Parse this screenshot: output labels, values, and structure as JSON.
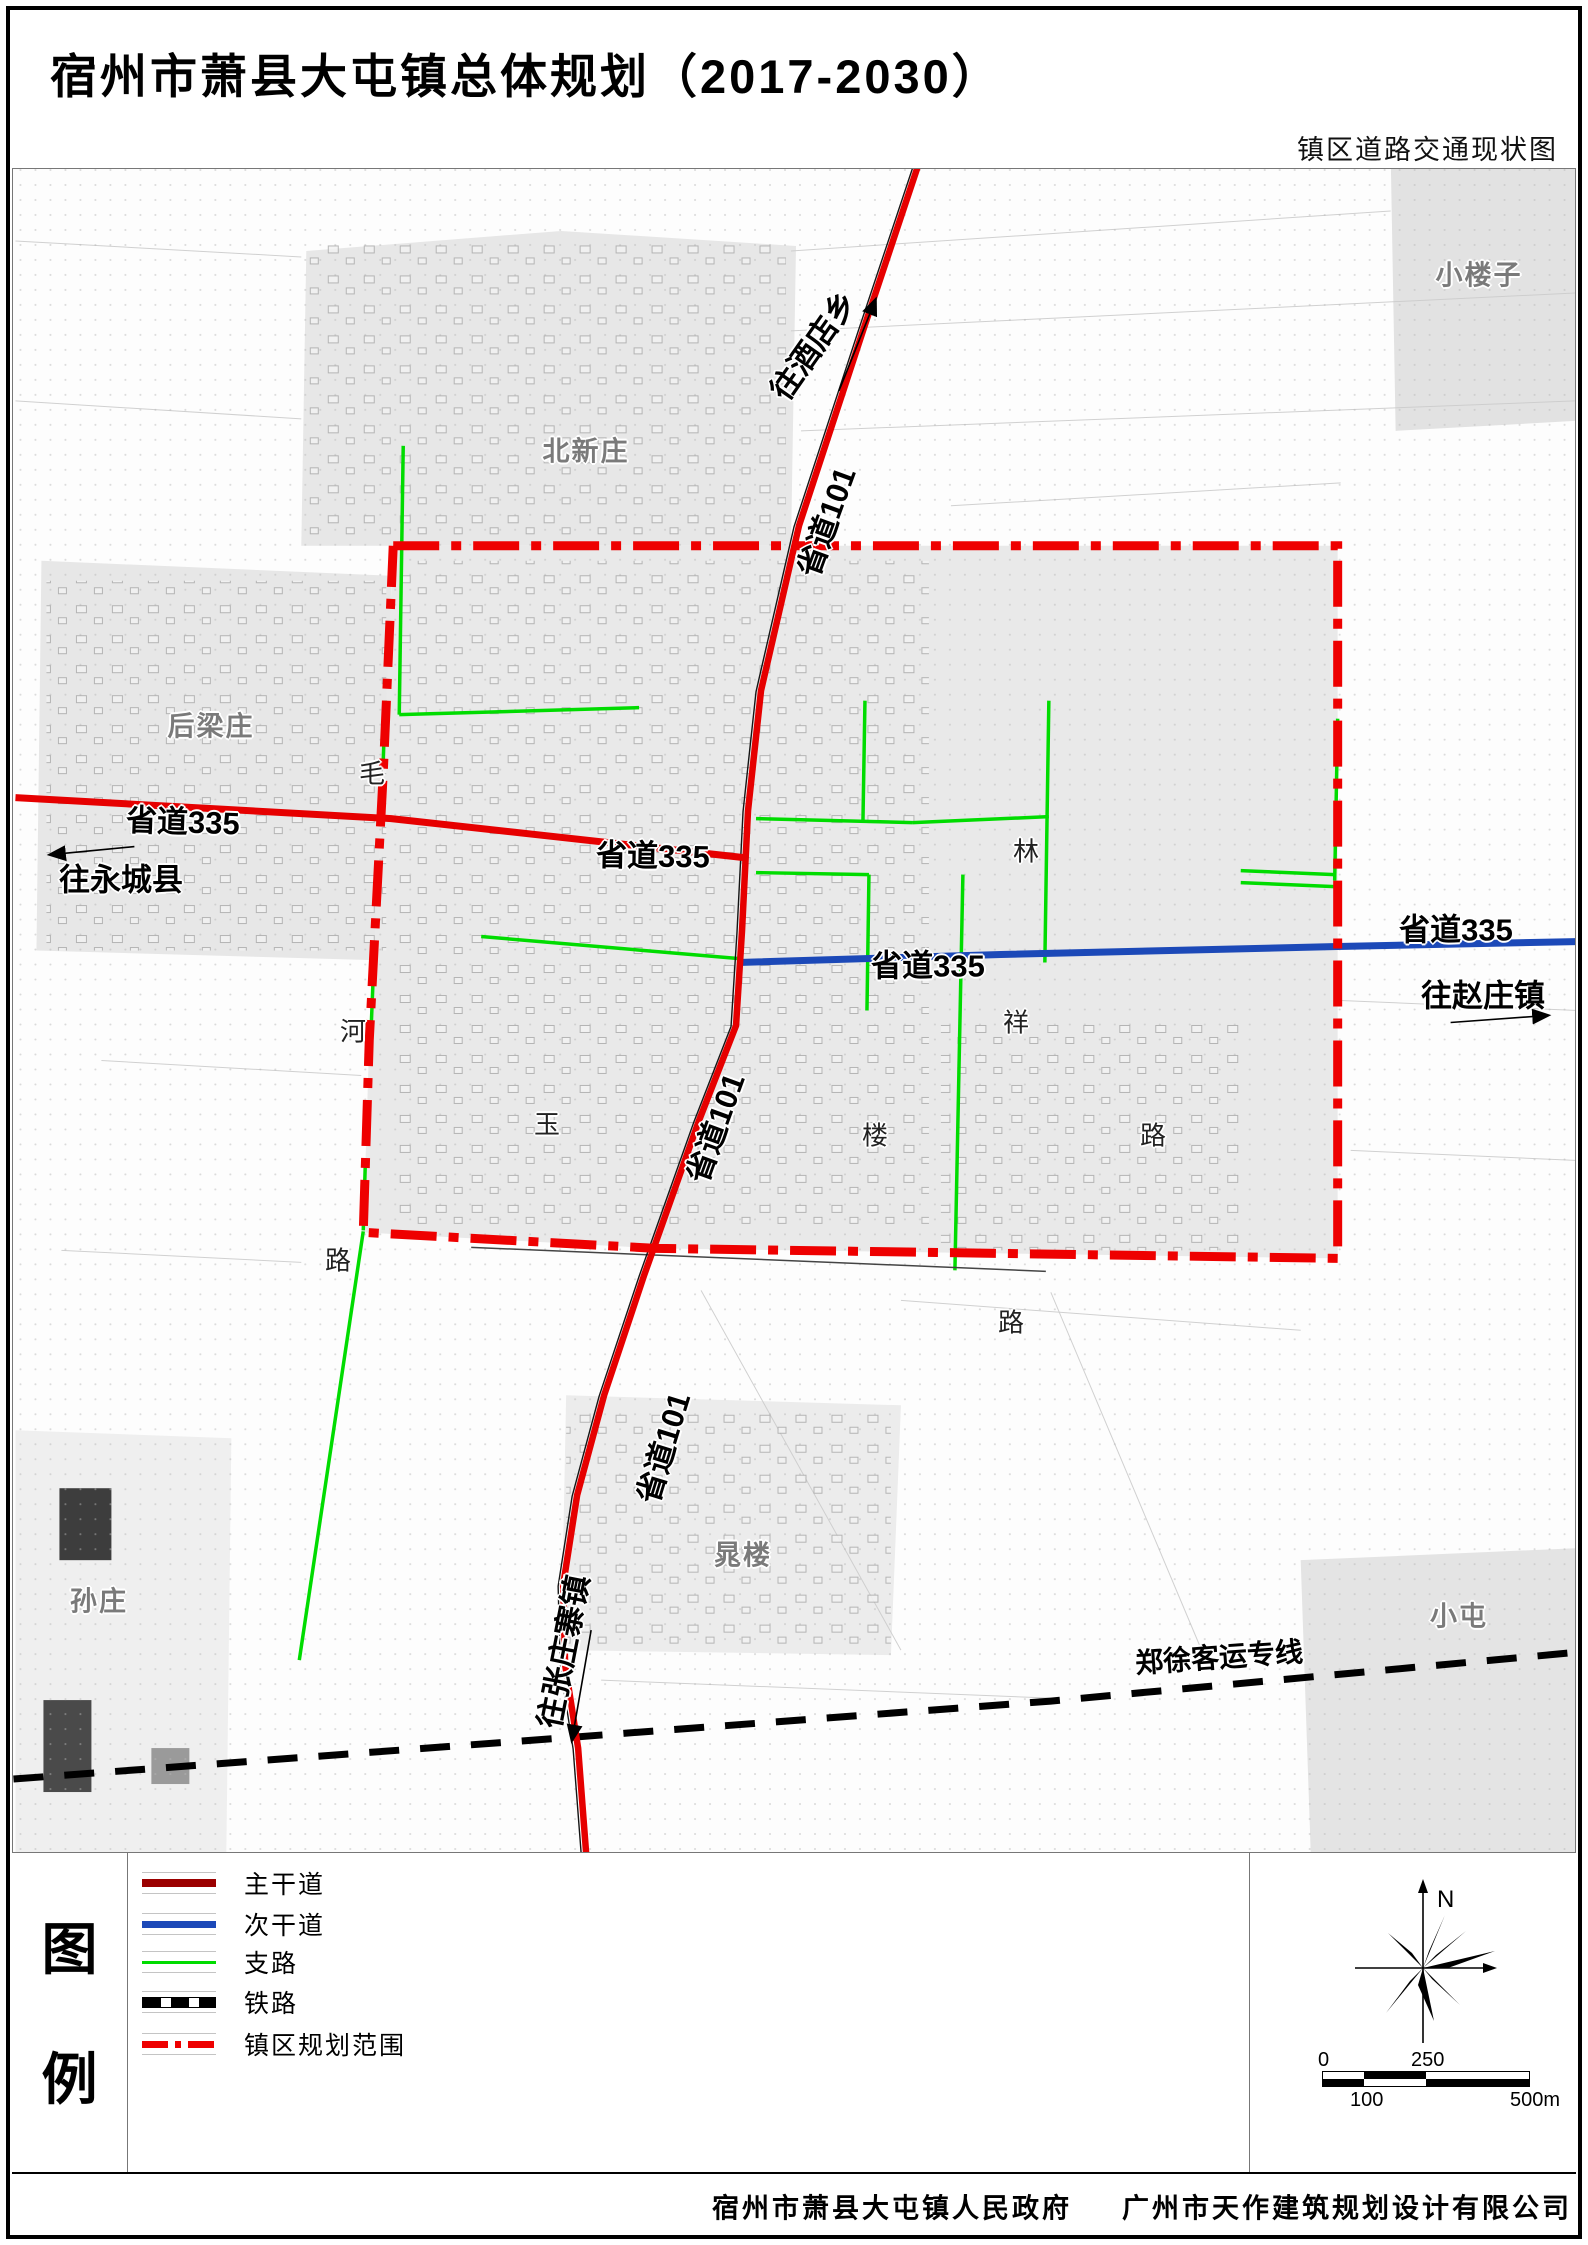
{
  "page": {
    "title": "宿州市萧县大屯镇总体规划（2017-2030）",
    "subtitle": "镇区道路交通现状图"
  },
  "colors": {
    "main_road": "#e60000",
    "main_road_legend": "#9b0000",
    "secondary_road": "#1c49b8",
    "branch_road": "#00dc00",
    "railway": "#000000",
    "boundary": "#ee0000",
    "urban_fill": "#e9e9e9",
    "village_label": "#7a7a7a"
  },
  "legend": {
    "heading_chars": [
      "图",
      "例"
    ],
    "items": [
      {
        "id": "main-road",
        "label": "主干道",
        "type": "main"
      },
      {
        "id": "secondary-road",
        "label": "次干道",
        "type": "secondary"
      },
      {
        "id": "branch-road",
        "label": "支路",
        "type": "branch"
      },
      {
        "id": "railway",
        "label": "铁路",
        "type": "railway"
      },
      {
        "id": "planning-boundary",
        "label": "镇区规划范围",
        "type": "boundary"
      }
    ]
  },
  "compass": {
    "north_label": "N"
  },
  "scale_bar": {
    "top_ticks": [
      {
        "t": "0",
        "x": 0
      },
      {
        "t": "250",
        "x": 93
      }
    ],
    "bottom_ticks": [
      {
        "t": "100",
        "x": 32
      },
      {
        "t": "500m",
        "x": 192
      }
    ]
  },
  "footer": {
    "left": "宿州市萧县大屯镇人民政府",
    "right": "广州市天作建筑规划设计有限公司"
  },
  "map": {
    "labels": [
      {
        "id": "s335-west-1",
        "t": "省道335",
        "x": 170,
        "y": 650,
        "r": 2,
        "k": "road"
      },
      {
        "id": "s335-west-2",
        "t": "省道335",
        "x": 640,
        "y": 684,
        "r": 1,
        "k": "road"
      },
      {
        "id": "s335-center",
        "t": "省道335",
        "x": 915,
        "y": 794,
        "r": 0,
        "k": "road"
      },
      {
        "id": "s335-east",
        "t": "省道335",
        "x": 1443,
        "y": 758,
        "r": 0,
        "k": "road"
      },
      {
        "id": "s101-north",
        "t": "省道101",
        "x": 811,
        "y": 352,
        "r": -70,
        "k": "road"
      },
      {
        "id": "s101-mid",
        "t": "省道101",
        "x": 700,
        "y": 958,
        "r": -70,
        "k": "road"
      },
      {
        "id": "s101-south",
        "t": "省道101",
        "x": 648,
        "y": 1278,
        "r": -73,
        "k": "road"
      },
      {
        "id": "to-jiudianxiang",
        "t": "往酒店乡",
        "x": 798,
        "y": 175,
        "r": -55,
        "k": "road"
      },
      {
        "id": "to-yongchengxian",
        "t": "往永城县",
        "x": 108,
        "y": 708,
        "r": 0,
        "k": "road"
      },
      {
        "id": "to-zhaozhuangzhen",
        "t": "往赵庄镇",
        "x": 1470,
        "y": 824,
        "r": 0,
        "k": "road"
      },
      {
        "id": "to-zhangzhuangzhaizhen",
        "t": "往张庄寨镇",
        "x": 548,
        "y": 1482,
        "r": -79,
        "k": "road"
      },
      {
        "id": "railway-name",
        "t": "郑徐客运专线",
        "x": 1206,
        "y": 1487,
        "r": -4,
        "k": "rail"
      },
      {
        "id": "xiaolouzi",
        "t": "小楼子",
        "x": 1466,
        "y": 104,
        "r": 0,
        "k": "place"
      },
      {
        "id": "beixinzhuang",
        "t": "北新庄",
        "x": 573,
        "y": 280,
        "r": 0,
        "k": "place"
      },
      {
        "id": "houliangzhuang",
        "t": "后梁庄",
        "x": 198,
        "y": 555,
        "r": 0,
        "k": "place"
      },
      {
        "id": "sunzhuang",
        "t": "孙庄",
        "x": 86,
        "y": 1430,
        "r": 0,
        "k": "place"
      },
      {
        "id": "xiaotun",
        "t": "小屯",
        "x": 1446,
        "y": 1445,
        "r": 0,
        "k": "place"
      },
      {
        "id": "chaolou",
        "t": "晁楼",
        "x": 730,
        "y": 1384,
        "r": 0,
        "k": "place"
      },
      {
        "id": "char-mao",
        "t": "毛",
        "x": 359,
        "y": 603,
        "r": 0,
        "k": "char"
      },
      {
        "id": "char-he",
        "t": "河",
        "x": 340,
        "y": 861,
        "r": 0,
        "k": "char"
      },
      {
        "id": "char-lu-west",
        "t": "路",
        "x": 325,
        "y": 1090,
        "r": 0,
        "k": "char"
      },
      {
        "id": "char-yu",
        "t": "玉",
        "x": 534,
        "y": 954,
        "r": 0,
        "k": "char"
      },
      {
        "id": "char-lin",
        "t": "林",
        "x": 1013,
        "y": 681,
        "r": 0,
        "k": "char"
      },
      {
        "id": "char-xiang",
        "t": "祥",
        "x": 1003,
        "y": 852,
        "r": 0,
        "k": "char"
      },
      {
        "id": "char-lou",
        "t": "楼",
        "x": 862,
        "y": 965,
        "r": 0,
        "k": "char"
      },
      {
        "id": "char-lu-east",
        "t": "路",
        "x": 1140,
        "y": 965,
        "r": 0,
        "k": "char"
      },
      {
        "id": "char-lu-south",
        "t": "路",
        "x": 998,
        "y": 1152,
        "r": 0,
        "k": "char"
      }
    ]
  }
}
